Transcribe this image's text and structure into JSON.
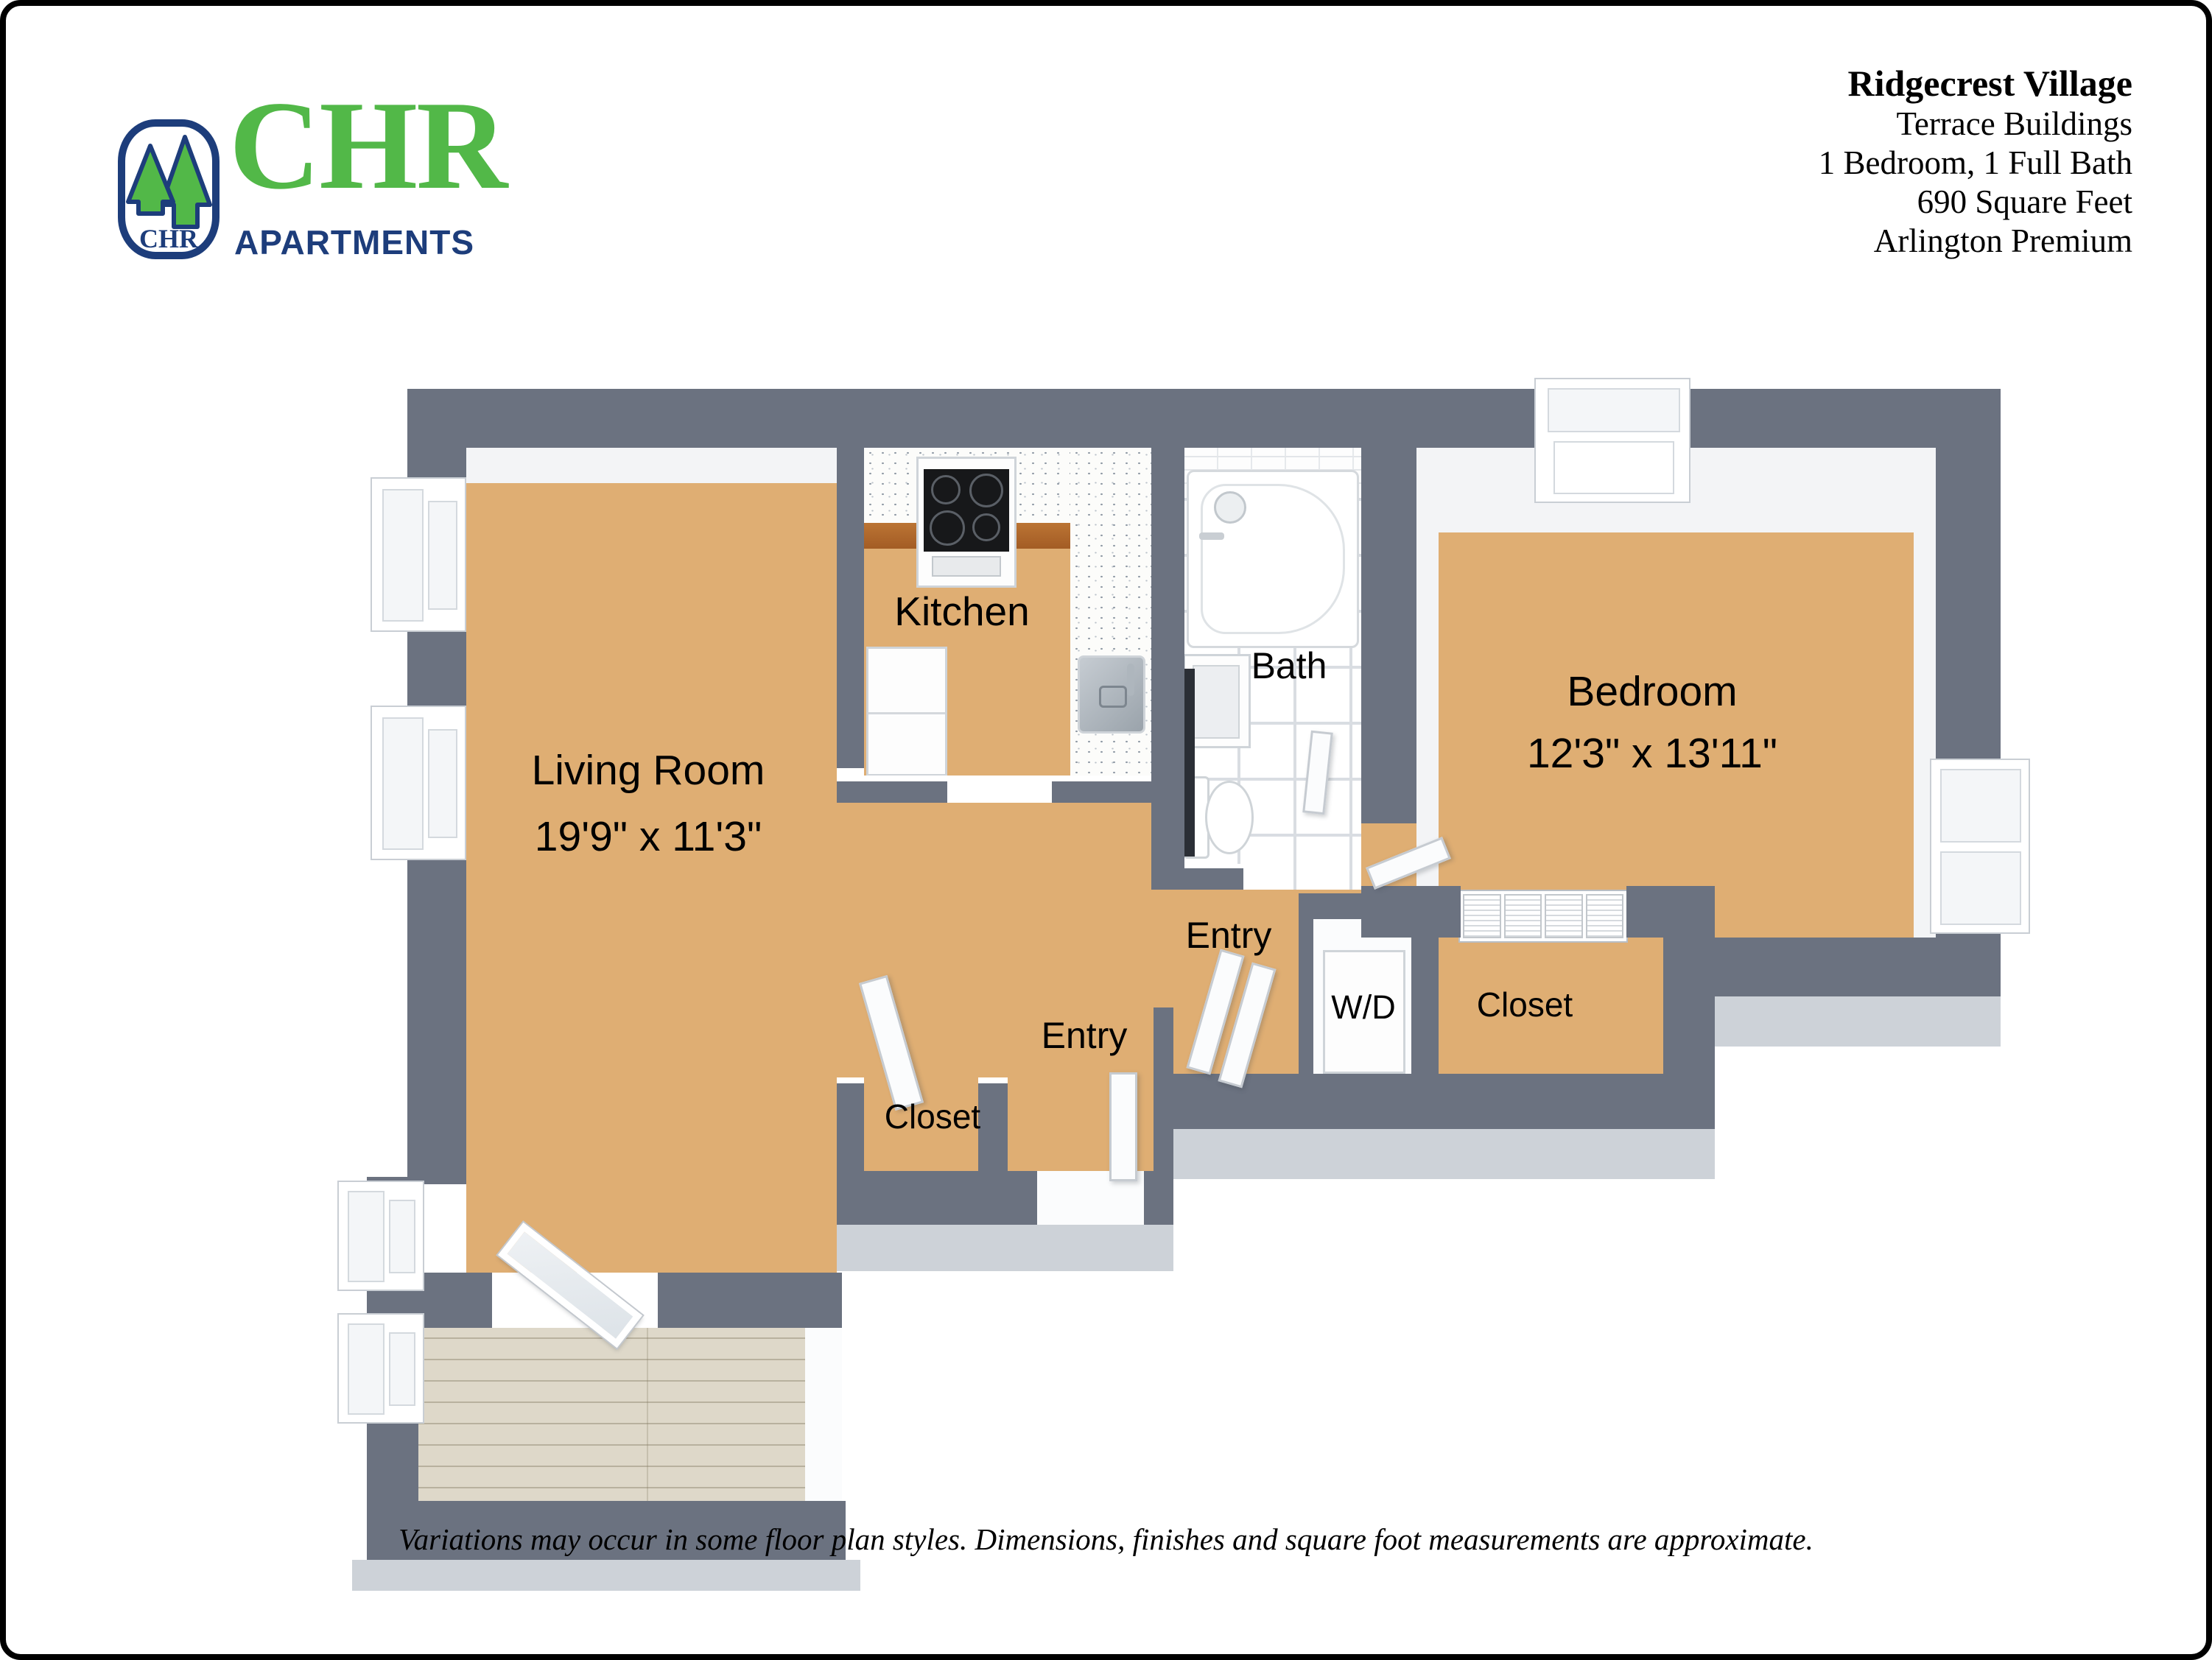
{
  "brand": {
    "badge_text": "CHR",
    "name": "CHR",
    "tagline": "APARTMENTS"
  },
  "header": {
    "property_name": "Ridgecrest Village",
    "building": "Terrace Buildings",
    "configuration": "1 Bedroom, 1 Full Bath",
    "area": "690 Square Feet",
    "tier": "Arlington Premium"
  },
  "rooms": {
    "living_room": {
      "label": "Living Room",
      "dimensions": "19'9\" x 11'3\""
    },
    "kitchen": {
      "label": "Kitchen"
    },
    "bath": {
      "label": "Bath"
    },
    "bedroom": {
      "label": "Bedroom",
      "dimensions": "12'3\" x 13'11\""
    },
    "entry_upper": {
      "label": "Entry"
    },
    "entry_lower": {
      "label": "Entry"
    },
    "washer_dryer": {
      "label": "W/D"
    },
    "bedroom_closet": {
      "label": "Closet"
    },
    "hall_closet": {
      "label": "Closet"
    }
  },
  "footer": {
    "disclaimer": "Variations may occur in some floor plan styles. Dimensions, finishes and square foot measurements are approximate."
  },
  "colors": {
    "wall": "#6b7280",
    "wall_outer_face": "#cdd2d8",
    "logo_green": "#52b848",
    "logo_navy": "#1d3d7b",
    "oak_floor": "#dfae73",
    "porch_floor": "#ded8c9",
    "bath_tile": "#ffffff",
    "counter_cabinet": "#b06a2e"
  }
}
